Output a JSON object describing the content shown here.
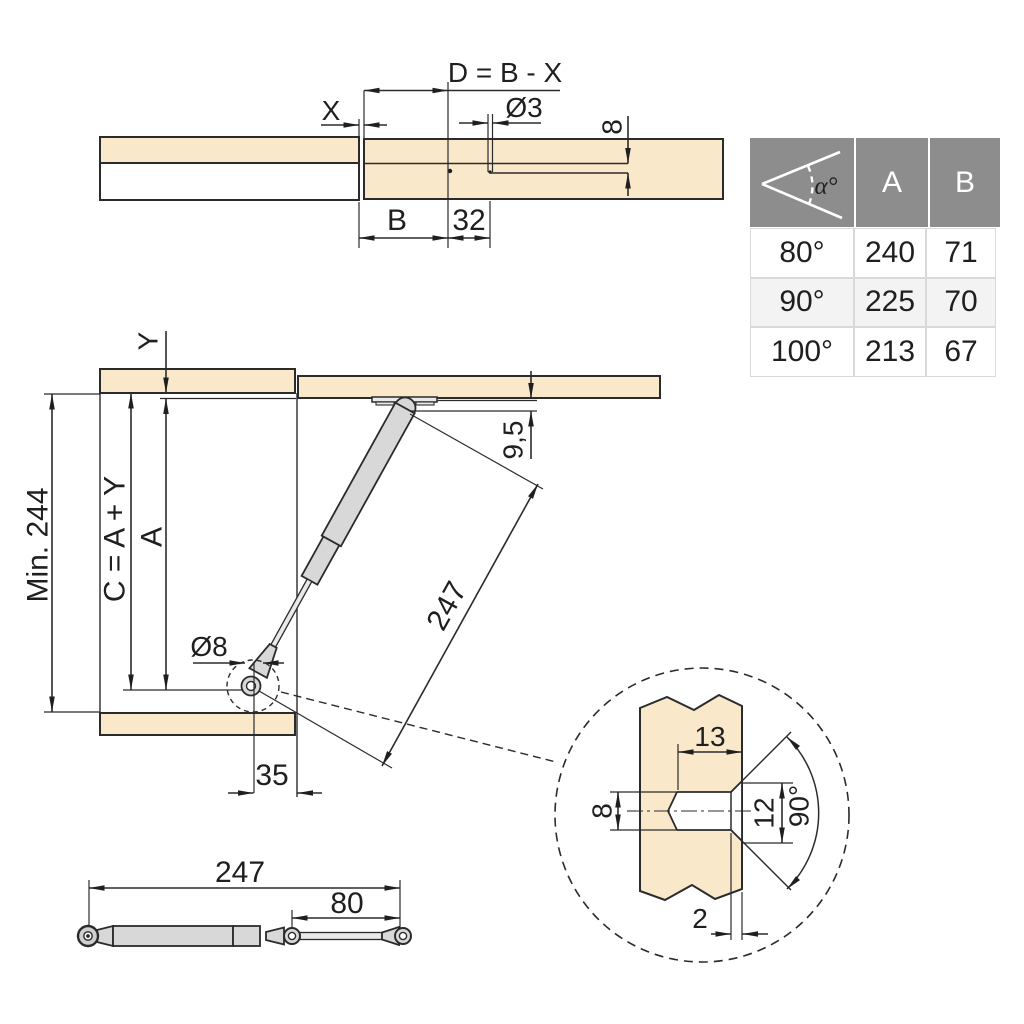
{
  "colors": {
    "wood": "#FAE8CB",
    "line": "#2B2B2B",
    "metal": "#D8D8D8",
    "metal_light": "#E9E9E9",
    "table_header_bg": "#8D8D8D",
    "table_alt_row": "#F3F3F3"
  },
  "top_drawing": {
    "formula": "D = B - X",
    "x_label": "X",
    "pilot_hole_dia": "Ø3",
    "hole_depth": "8",
    "b_label": "B",
    "hole_offset": "32"
  },
  "table": {
    "header": {
      "angle": "α°",
      "a": "A",
      "b": "B"
    },
    "rows": [
      {
        "angle": "80°",
        "a": "240",
        "b": "71"
      },
      {
        "angle": "90°",
        "a": "225",
        "b": "70"
      },
      {
        "angle": "100°",
        "a": "213",
        "b": "67"
      }
    ]
  },
  "main_diagram": {
    "y_label": "Y",
    "min_height": "Min. 244",
    "c_formula": "C = A + Y",
    "a_label": "A",
    "pivot_drop": "9,5",
    "strut_length": "247",
    "socket_dia": "Ø8",
    "side_offset": "35"
  },
  "strut_drawing": {
    "total_length": "247",
    "rod_length": "80"
  },
  "detail": {
    "hole_depth": "13",
    "hole_dia": "8",
    "countersink_dia": "12",
    "countersink_angle": "90°",
    "countersink_depth": "2"
  }
}
